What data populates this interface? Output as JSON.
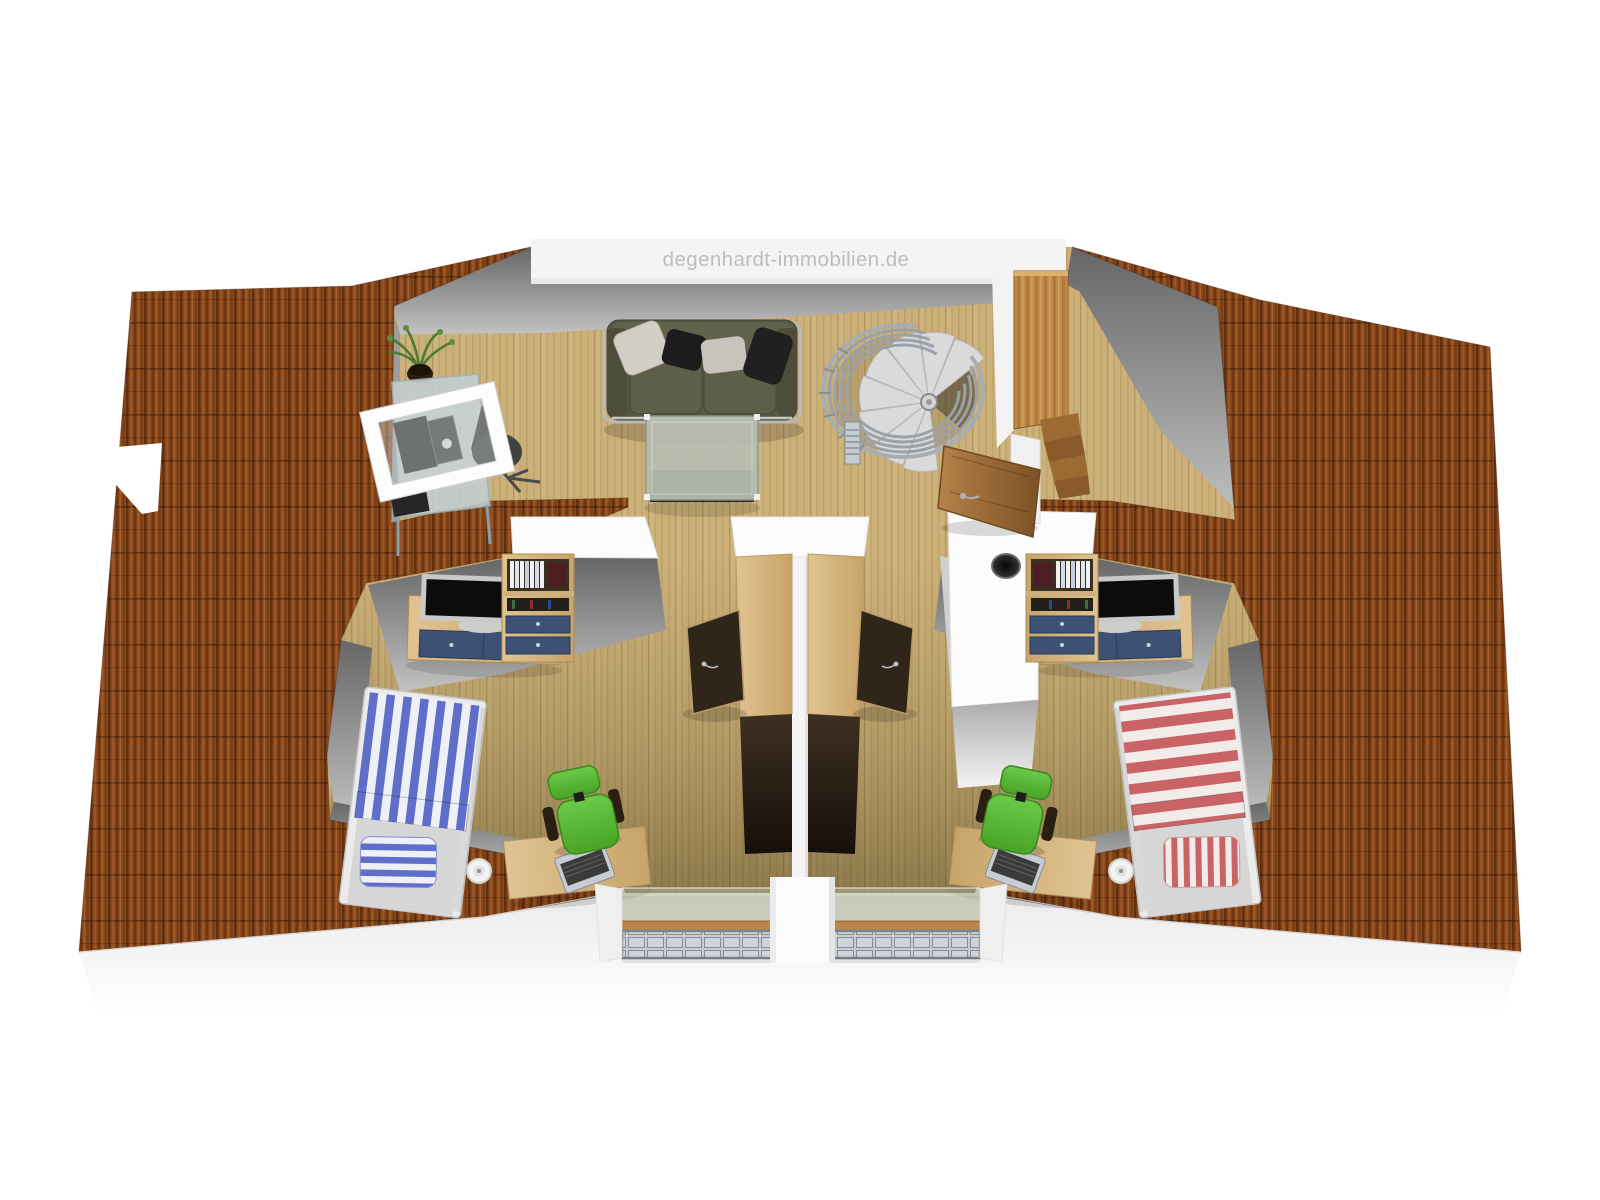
{
  "watermark": {
    "text": "degenhardt-immobilien.de"
  },
  "scene": {
    "type": "3d-floor-plan-top-view",
    "floor_name": "attic-floor",
    "rooms": [
      {
        "id": "living-room",
        "furniture": [
          "sofa",
          "pillows",
          "coffee-table",
          "glass-desk",
          "open-roof-window",
          "office-chair",
          "potted-plant",
          "spiral-staircase"
        ]
      },
      {
        "id": "hallway",
        "furniture": [
          "tall-wardrobe",
          "step-shelf",
          "open-door"
        ]
      },
      {
        "id": "kids-room-left",
        "accent_color": "#5f6fc9",
        "furniture": [
          "striped-bed-blue",
          "tv-sideboard",
          "bookshelf",
          "desk",
          "laptop",
          "swivel-chair-green",
          "paper-roll",
          "balcony-window"
        ]
      },
      {
        "id": "kids-room-right",
        "accent_color": "#ca6365",
        "furniture": [
          "striped-bed-red",
          "tv-sideboard",
          "bookshelf",
          "desk",
          "laptop",
          "swivel-chair-green",
          "paper-roll",
          "chimney",
          "balcony-window"
        ]
      }
    ]
  },
  "palette": {
    "page_bg": "#ffffff",
    "roof": "#8a4a1e",
    "roof_dark": "#5f2d0d",
    "floor_wood": "#ccb07a",
    "kids_floor_shade": "#8a7848",
    "wall_white": "#f6f6f6",
    "wall_gray": "#7a7a7a",
    "sofa_olive": "#565844",
    "table_glass": "#b7beb3",
    "bed_blue": "#5f6fc9",
    "bed_red": "#ca6365",
    "chair_green": "#55b42e",
    "wood_light": "#dec69a",
    "wood_mid": "#c08849",
    "wood_dark": "#2d2318",
    "metal_gray": "#9aa1a8",
    "watermark_text": "#bdbdbd"
  }
}
